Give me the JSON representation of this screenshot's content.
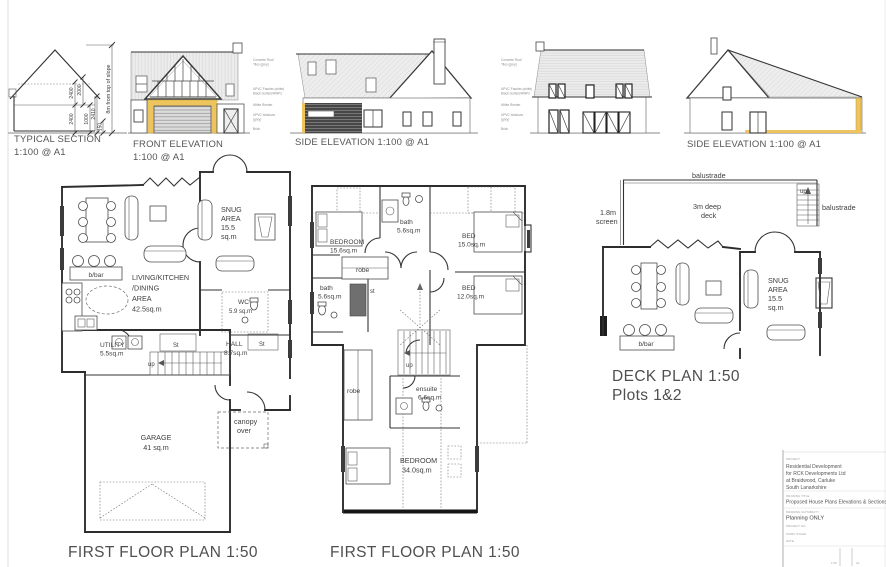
{
  "titles": {
    "section": "TYPICAL SECTION",
    "section_scale": "1:100 @ A1",
    "front": "FRONT ELEVATION",
    "front_scale": "1:100 @ A1",
    "side_left": "SIDE ELEVATION 1:100 @ A1",
    "side_right": "SIDE ELEVATION 1:100 @ A1",
    "plan1": "FIRST FLOOR PLAN 1:50",
    "plan2": "FIRST FLOOR PLAN 1:50",
    "plan3_line1": "DECK PLAN 1:50",
    "plan3_line2": "Plots 1&2"
  },
  "section_dims": {
    "d2400a": "2400",
    "d2000": "2000",
    "d2400b": "2400",
    "d1000": "1000",
    "d2410": "2410",
    "d150": "150",
    "slope_note": "8m from top of slope"
  },
  "material_notes": [
    "Concrete Roof",
    "Tiles (grey)",
    "UPVC Fascias (white)",
    "Black Gutters/RWPs",
    "White Render",
    "UPVC windows",
    "(grey)",
    "Brick"
  ],
  "plan1": {
    "snug": [
      "SNUG",
      "AREA",
      "15.5",
      "sq.m"
    ],
    "living": [
      "LIVING/KITCHEN",
      "/DINING",
      "AREA",
      "42.5sq.m"
    ],
    "bbar": "b/bar",
    "wc1": "WC",
    "wc2": "5.9 sq.m",
    "utility1": "UTILITY",
    "utility2": "5.5sq.m",
    "st_a": "St",
    "st_b": "St",
    "up": "up",
    "hall1": "HALL",
    "hall2": "8.7sq.m",
    "canopy1": "canopy",
    "canopy2": "over",
    "garage1": "GARAGE",
    "garage2": "41 sq.m"
  },
  "plan2": {
    "bedroom1a": "BEDROOM",
    "bedroom1b": "15.6sq.m",
    "bath_top1": "bath",
    "bath_top2": "5.6sq.m",
    "bed15a": "BED",
    "bed15b": "15.0sq.m",
    "robe_top": "robe",
    "bath_left1": "bath",
    "bath_left2": "5.6sq.m",
    "st": "st",
    "bed12a": "BED",
    "bed12b": "12.0sq.m",
    "up": "up",
    "robe_low": "robe",
    "ensuite1": "ensuite",
    "ensuite2": "6.6sq.m",
    "master1": "BEDROOM",
    "master2": "34.0sq.m"
  },
  "plan3": {
    "balustrade_top": "balustrade",
    "balustrade_right": "balustrade",
    "deck1": "3m deep",
    "deck2": "deck",
    "screen1": "1.8m",
    "screen2": "screen",
    "up": "up",
    "snug": [
      "SNUG",
      "AREA",
      "15.5",
      "sq.m"
    ],
    "bbar": "b/bar"
  },
  "titleblock": {
    "project_label": "PROJECT",
    "project_lines": [
      "Residential Development",
      "for RCK Developments Ltd",
      "at Braidwood, Carluke",
      "South Lanarkshire"
    ],
    "drawing_label": "DRAWING TITLE",
    "drawing_title": "Proposed House Plans Elevations & Sections",
    "suitability_label": "DRAWING SUITABILITY",
    "suitability": "Planning ONLY",
    "meta": [
      "PROJECT NO.",
      "WORK STAGE",
      "DATE"
    ],
    "scale": "1:50",
    "sheet": "A1"
  },
  "colors": {
    "accent_yellow": "#eec45f",
    "line_dark": "#2d2d2d",
    "roof_fill": "#ececec",
    "clad_dark": "#474747"
  }
}
